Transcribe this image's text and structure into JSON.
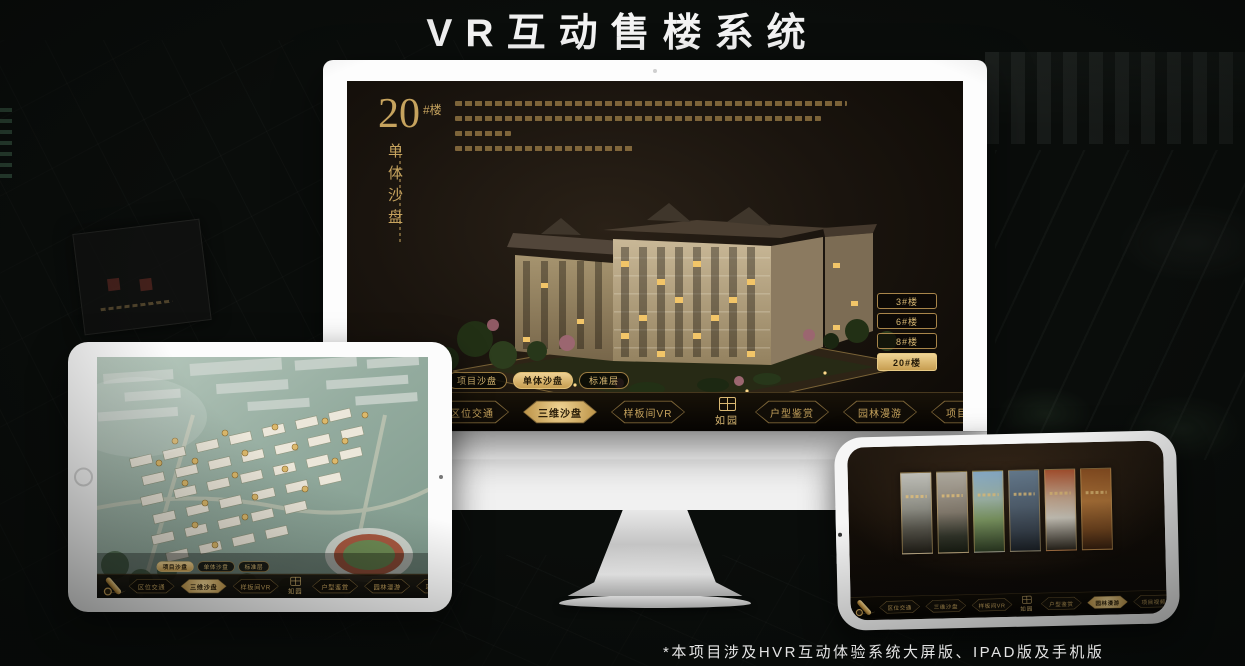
{
  "page": {
    "title": "VR互动售楼系统",
    "footnote": "*本项目涉及HVR互动体验系统大屏版、IPAD版及手机版"
  },
  "colors": {
    "gold": "#d4af6e",
    "gold_deep": "#a8854a",
    "screen_brown": "#1b1510",
    "active_text": "#241a08"
  },
  "brand": {
    "logo_text": "如园",
    "logo_icon": "seal-icon",
    "nav_end_icon": "gold-scroll-icon"
  },
  "monitor": {
    "headline": {
      "number": "20",
      "suffix": "#楼",
      "subtitle_vertical": "单体沙盘"
    },
    "tabs": [
      {
        "label": "项目沙盘",
        "active": false
      },
      {
        "label": "单体沙盘",
        "active": true
      },
      {
        "label": "标准层",
        "active": false
      }
    ],
    "nav": [
      {
        "label": "区位交通",
        "active": false
      },
      {
        "label": "三维沙盘",
        "active": true
      },
      {
        "label": "样板间VR",
        "active": false
      },
      {
        "label": "户型鉴赏",
        "active": false
      },
      {
        "label": "园林漫游",
        "active": false
      },
      {
        "label": "项目视频",
        "active": false
      }
    ],
    "side_buttons": [
      {
        "label": "3#楼",
        "active": false
      },
      {
        "label": "6#楼",
        "active": false
      },
      {
        "label": "8#楼",
        "active": false
      },
      {
        "label": "20#楼",
        "active": true
      }
    ]
  },
  "tablet": {
    "tabs": [
      {
        "label": "项目沙盘",
        "active": true
      },
      {
        "label": "单体沙盘",
        "active": false
      },
      {
        "label": "标准层",
        "active": false
      }
    ],
    "nav": [
      {
        "label": "区位交通",
        "active": false
      },
      {
        "label": "三维沙盘",
        "active": true
      },
      {
        "label": "样板间VR",
        "active": false
      },
      {
        "label": "户型鉴赏",
        "active": false
      },
      {
        "label": "园林漫游",
        "active": false
      },
      {
        "label": "项目视频",
        "active": false
      }
    ]
  },
  "phone": {
    "nav": [
      {
        "label": "区位交通",
        "active": false
      },
      {
        "label": "三维沙盘",
        "active": false
      },
      {
        "label": "样板间VR",
        "active": false
      },
      {
        "label": "户型鉴赏",
        "active": false
      },
      {
        "label": "园林漫游",
        "active": true
      },
      {
        "label": "项目视频",
        "active": false
      }
    ]
  }
}
